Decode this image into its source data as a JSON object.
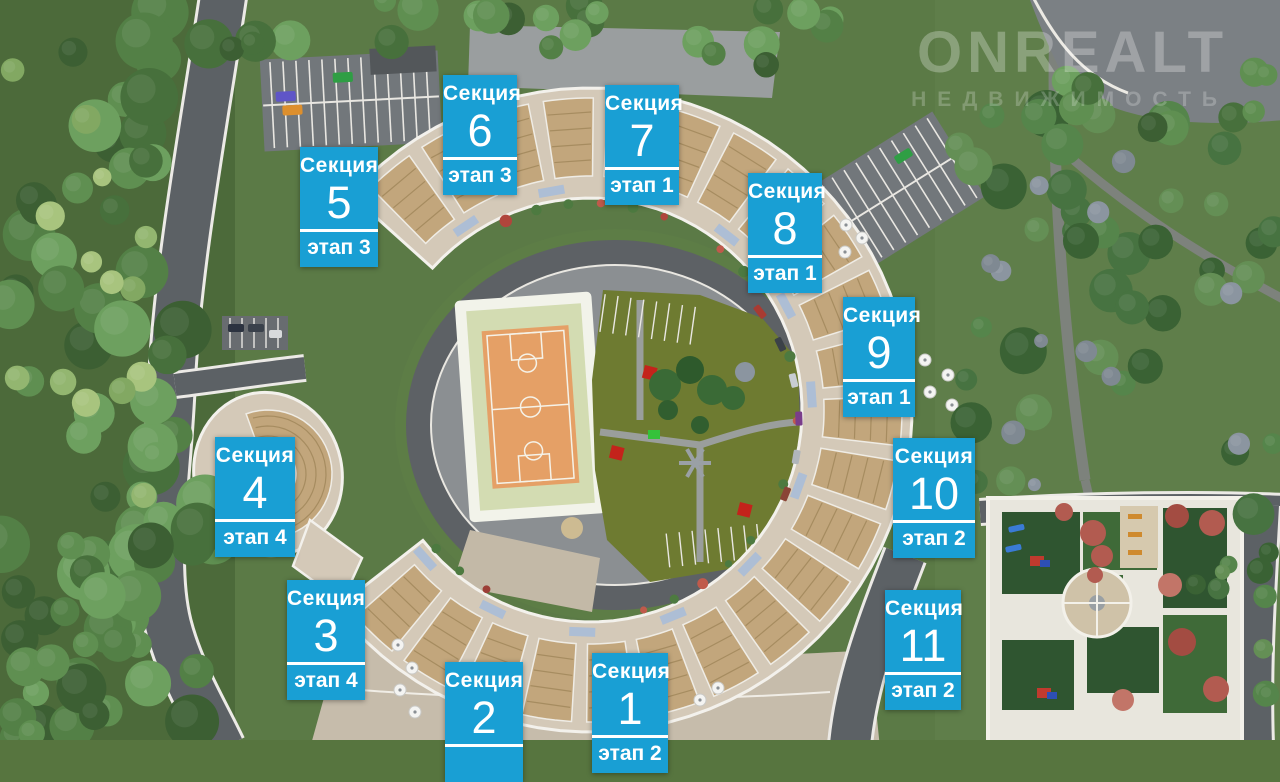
{
  "watermark": {
    "brand": "ONREALT",
    "subtitle": "НЕДВИЖИМОСТЬ"
  },
  "label_words": {
    "section": "Секция",
    "stage": "этап"
  },
  "sections": [
    {
      "number": "1",
      "stage": "этап 2"
    },
    {
      "number": "2",
      "stage": ""
    },
    {
      "number": "3",
      "stage": "этап 4"
    },
    {
      "number": "4",
      "stage": "этап 4"
    },
    {
      "number": "5",
      "stage": "этап 3"
    },
    {
      "number": "6",
      "stage": "этап 3"
    },
    {
      "number": "7",
      "stage": "этап 1"
    },
    {
      "number": "8",
      "stage": "этап 1"
    },
    {
      "number": "9",
      "stage": "этап 1"
    },
    {
      "number": "10",
      "stage": "этап 2"
    },
    {
      "number": "11",
      "stage": "этап 2"
    }
  ],
  "colors": {
    "label_background": "#199fd4",
    "label_text": "#ffffff",
    "court_orange": "#e5a066",
    "playground_olive": "#6e7b31",
    "building_roof_tan": "#c2a67c",
    "building_terrace": "#d4c9b8"
  }
}
